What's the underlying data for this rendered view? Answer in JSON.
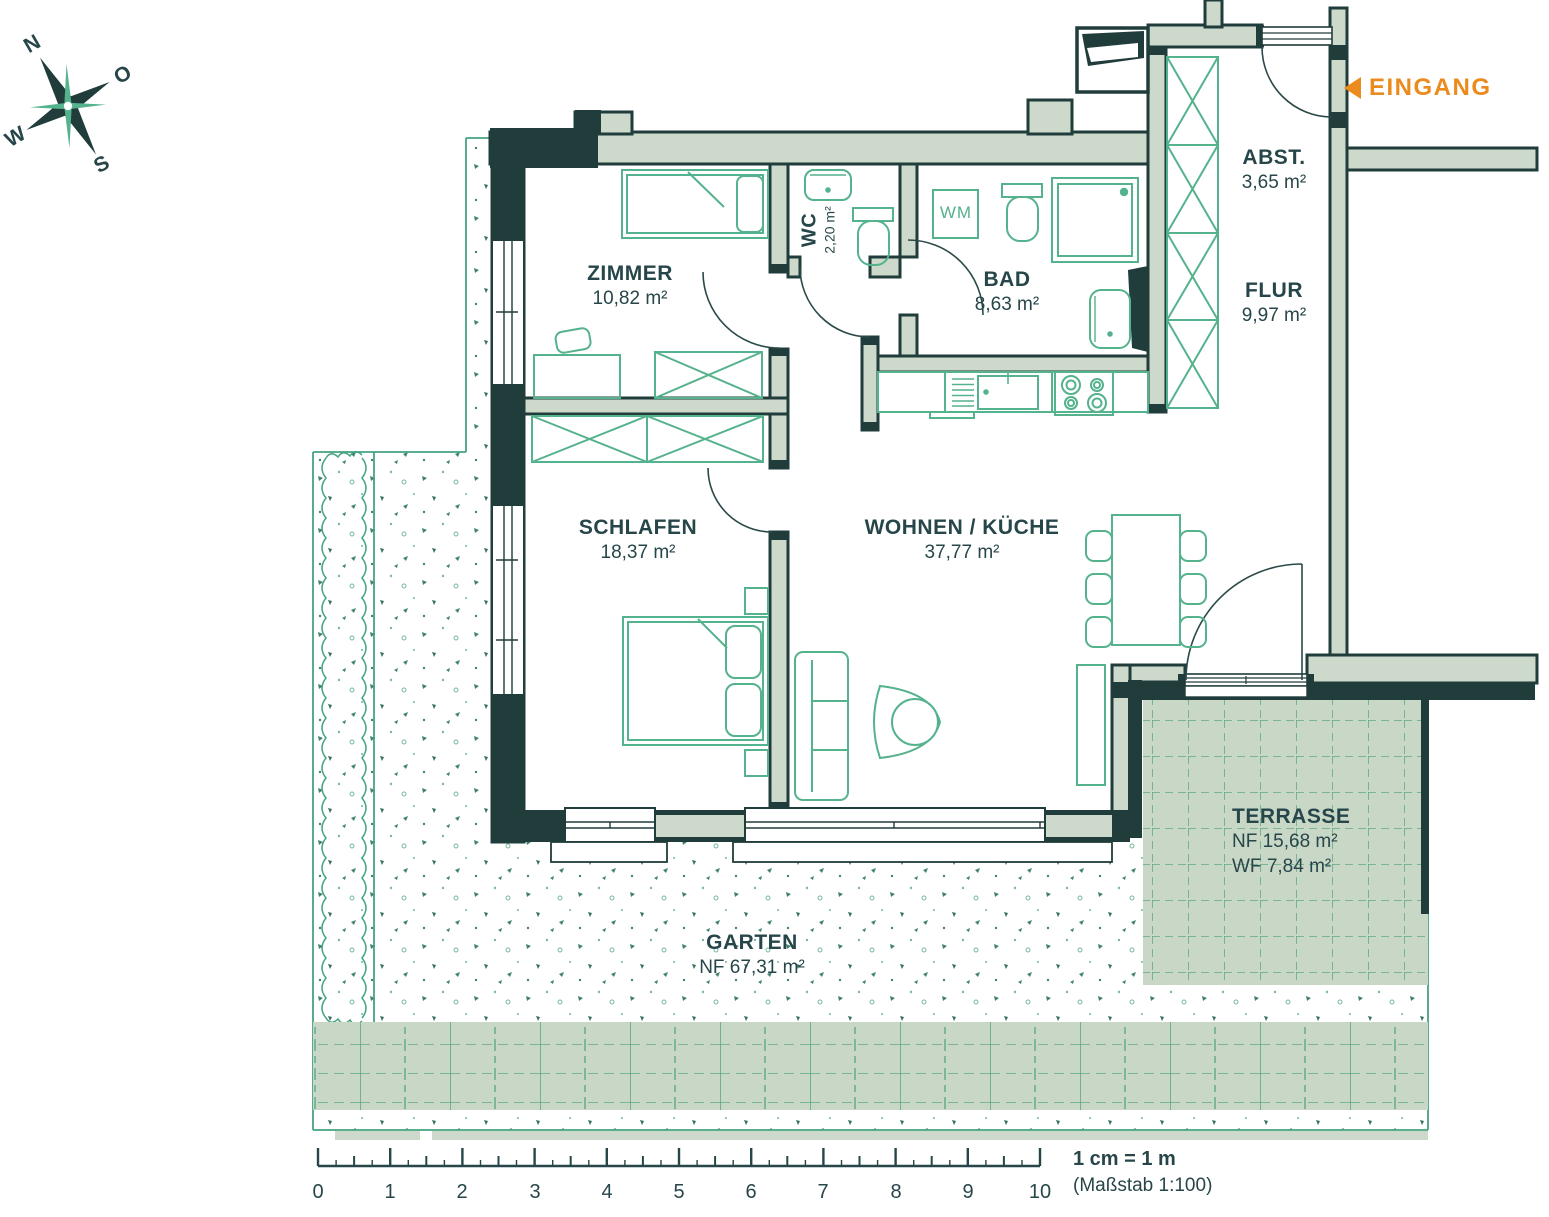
{
  "title": "Wohnungsgrundriss",
  "compass": {
    "n": "N",
    "o": "O",
    "w": "W",
    "s": "S"
  },
  "entrance": {
    "label": "EINGANG"
  },
  "rooms": {
    "zimmer": {
      "name": "ZIMMER",
      "area": "10,82 m²"
    },
    "wc": {
      "name": "WC",
      "area": "2,20 m²"
    },
    "bad": {
      "name": "BAD",
      "area": "8,63 m²"
    },
    "abst": {
      "name": "ABST.",
      "area": "3,65 m²"
    },
    "flur": {
      "name": "FLUR",
      "area": "9,97 m²"
    },
    "schlafen": {
      "name": "SCHLAFEN",
      "area": "18,37 m²"
    },
    "wohnen": {
      "name": "WOHNEN / KÜCHE",
      "area": "37,77 m²"
    },
    "terrasse": {
      "name": "TERRASSE",
      "nf": "NF  15,68 m²",
      "wf": "WF 7,84 m²"
    },
    "garten": {
      "name": "GARTEN",
      "nf": "NF  67,31 m²"
    }
  },
  "appliances": {
    "wm": "WM"
  },
  "scale": {
    "ticks": [
      "0",
      "1",
      "2",
      "3",
      "4",
      "5",
      "6",
      "7",
      "8",
      "9",
      "10"
    ],
    "legend_bold": "1 cm = 1 m",
    "legend_sub": "(Maßstab 1:100)"
  },
  "colors": {
    "accent_orange": "#eb8b1e",
    "wall_fill": "#cdd9cb",
    "wall_outline": "#203c3b",
    "furniture_green": "#54b28c",
    "tile_fill": "#c9d7c7",
    "grid_green": "#4aa07e",
    "text": "#274649"
  }
}
